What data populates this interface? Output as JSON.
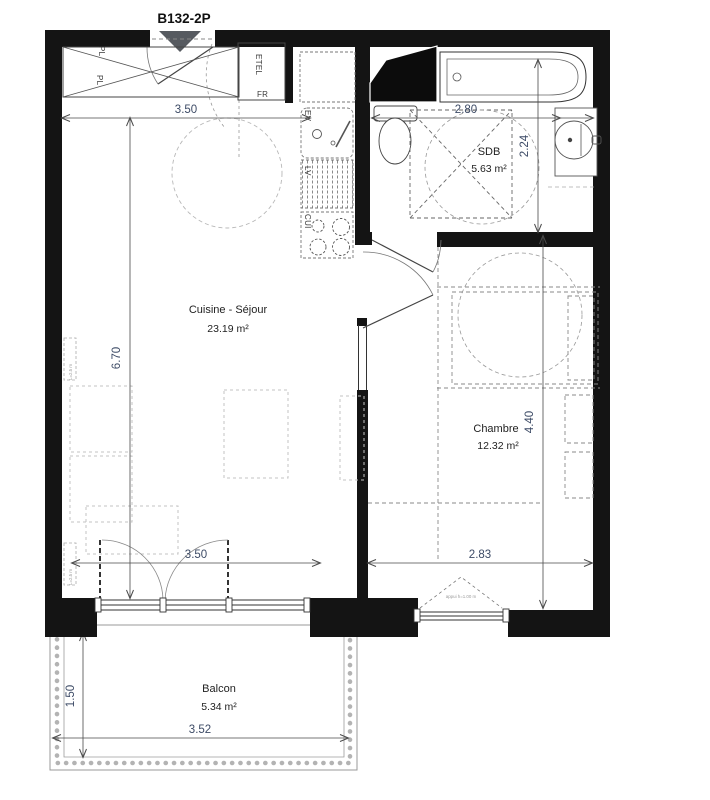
{
  "title": "B132-2P",
  "rooms": {
    "living": {
      "name": "Cuisine - Séjour",
      "area": "23.19 m²"
    },
    "bathroom": {
      "name": "SDB",
      "area": "5.63 m²"
    },
    "bedroom": {
      "name": "Chambre",
      "area": "12.32 m²"
    },
    "balcony": {
      "name": "Balcon",
      "area": "5.34 m²"
    }
  },
  "fixtures": {
    "closet_left": "PL",
    "closet_left_2": "PL",
    "electrical_space": "ETEL",
    "fridge": "FR",
    "sink": "EV",
    "dishwasher": "LV",
    "cooktop": "CUI"
  },
  "dims": {
    "living_width_top": "3.50",
    "living_length": "6.70",
    "bathroom_width": "2.80",
    "bathroom_length": "2.24",
    "bedroom_length": "4.40",
    "bedroom_width": "2.83",
    "living_width_bottom": "3.50",
    "balcony_width": "3.52",
    "balcony_depth": "1.50"
  },
  "annotations": {
    "radiator_top": "L=2.5 m",
    "radiator_bottom": "L=2.5 m",
    "window_sill": "appui h=1.00 m"
  },
  "colors": {
    "wall": "#141414",
    "entry_marker": "#565a60"
  }
}
